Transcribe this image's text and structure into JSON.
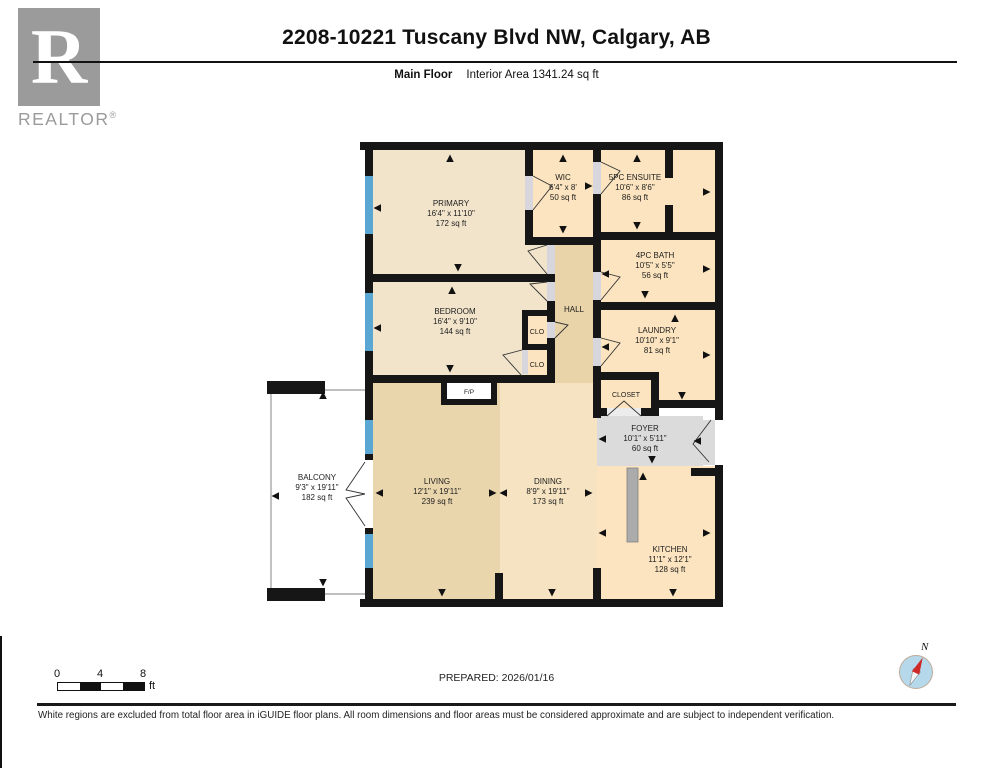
{
  "header": {
    "title": "2208-10221 Tuscany Blvd NW, Calgary, AB",
    "floor_label": "Main Floor",
    "interior_area": "Interior Area 1341.24 sq ft"
  },
  "logo": {
    "letter": "R",
    "brand": "REALTOR",
    "registered": "®"
  },
  "plan": {
    "rooms": {
      "primary": {
        "name": "PRIMARY",
        "dims": "16'4\" x 11'10\"",
        "area": "172 sq ft"
      },
      "wic": {
        "name": "WIC",
        "dims": "6'4\" x 8'",
        "area": "50 sq ft"
      },
      "ensuite": {
        "name": "5PC ENSUITE",
        "dims": "10'6\" x 8'6\"",
        "area": "86 sq ft"
      },
      "bath": {
        "name": "4PC BATH",
        "dims": "10'5\" x 5'5\"",
        "area": "56 sq ft"
      },
      "laundry": {
        "name": "LAUNDRY",
        "dims": "10'10\" x 9'1\"",
        "area": "81 sq ft"
      },
      "bedroom": {
        "name": "BEDROOM",
        "dims": "16'4\" x 9'10\"",
        "area": "144 sq ft"
      },
      "living": {
        "name": "LIVING",
        "dims": "12'1\" x 19'11\"",
        "area": "239 sq ft"
      },
      "dining": {
        "name": "DINING",
        "dims": "8'9\" x 19'11\"",
        "area": "173 sq ft"
      },
      "kitchen": {
        "name": "KITCHEN",
        "dims": "11'1\" x 12'1\"",
        "area": "128 sq ft"
      },
      "foyer": {
        "name": "FOYER",
        "dims": "10'1\" x 5'11\"",
        "area": "60 sq ft"
      },
      "balcony": {
        "name": "BALCONY",
        "dims": "9'3\" x 19'11\"",
        "area": "182 sq ft"
      }
    },
    "labels": {
      "hall": "HALL",
      "clo_upper": "CLO",
      "clo_lower": "CLO",
      "closet": "CLOSET",
      "fireplace": "F/P"
    }
  },
  "scale_bar": {
    "tick0": "0",
    "tick4": "4",
    "tick8": "8",
    "unit": "ft"
  },
  "prepared": "PREPARED: 2026/01/16",
  "compass": {
    "north": "N"
  },
  "disclaimer": "White regions are excluded from total floor area in iGUIDE floor plans. All room dimensions and floor areas must be considered approximate and are subject to independent verification.",
  "colors": {
    "room_beige": "#f1e4cb",
    "room_peach": "#fbe4bf",
    "hall_tan": "#e9d3a9",
    "living_tan": "#ead6ad",
    "dining_beige": "#f6e3c1",
    "foyer_gray": "#dbdbdb",
    "wall": "#161616",
    "window_blue": "#5aa7d3",
    "door_gray": "#d6d6dc",
    "compass_red": "#cf2a27",
    "compass_blue": "#b5d8eb",
    "logo_gray": "#9b9b9b"
  }
}
